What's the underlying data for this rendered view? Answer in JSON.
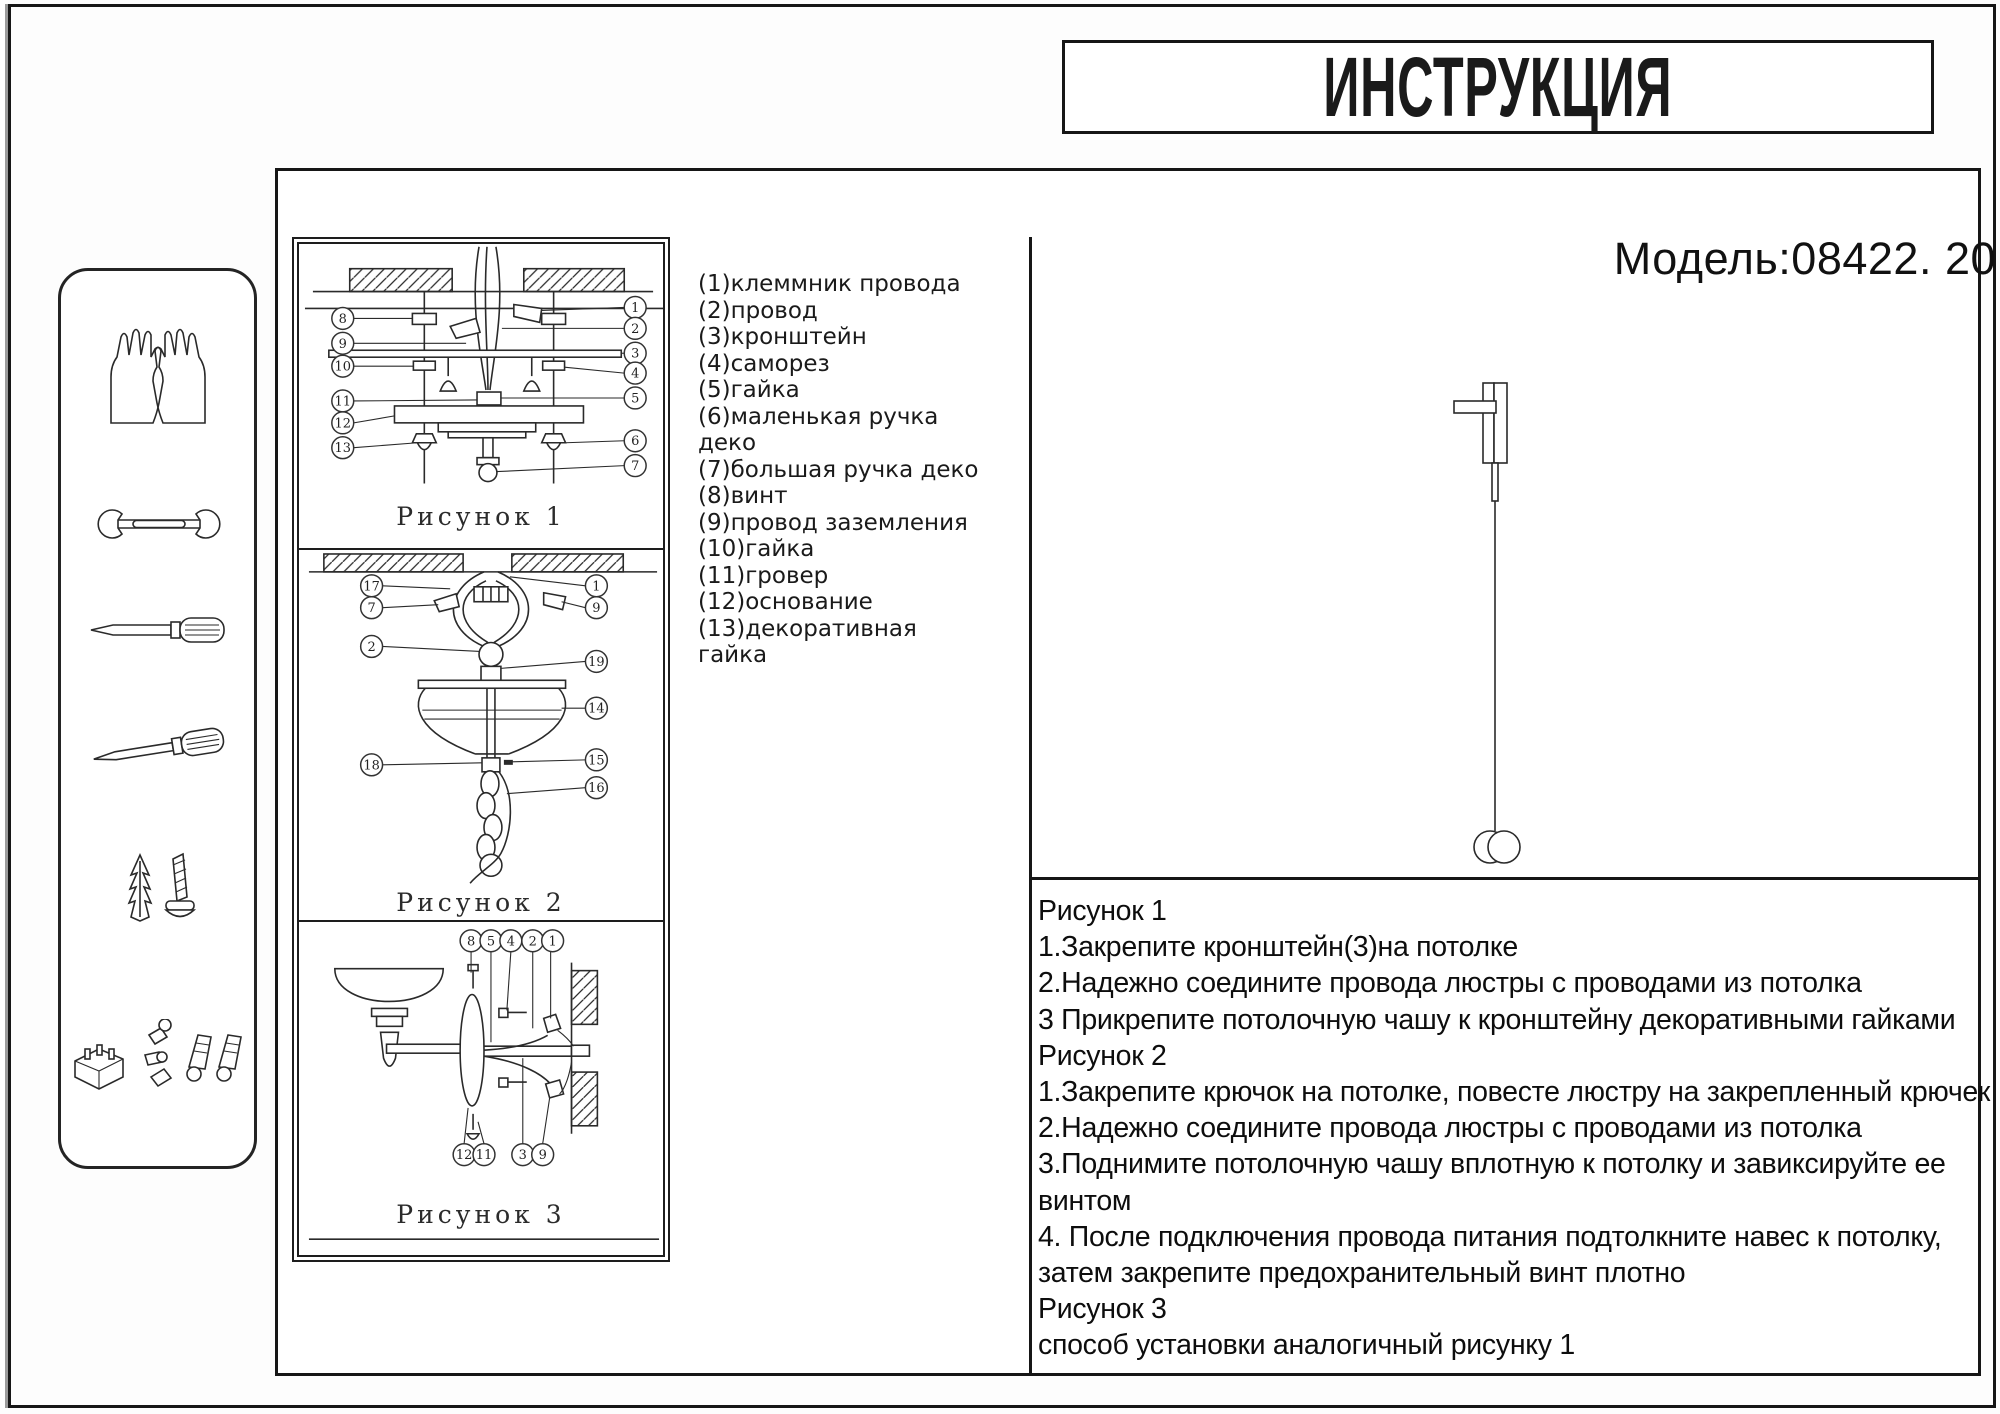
{
  "title": "ИНСТРУКЦИЯ",
  "model": "Модель:08422. 20",
  "colors": {
    "line": "#2a2a2a",
    "border": "#161616",
    "background": "#ffffff"
  },
  "parts_list": {
    "lines": [
      "(1)клеммник провода",
      "(2)провод",
      "(3)кронштейн",
      "(4)саморез",
      "(5)гайка",
      "(6)маленькая ручка",
      "деко",
      "(7)большая ручка деко",
      "(8)винт",
      "(9)провод заземления",
      "(10)гайка",
      "(11)гровер",
      "(12)основание",
      "(13)декоративная",
      "гайка"
    ]
  },
  "figures": {
    "fig1": {
      "caption": "Рисунок 1",
      "callouts_left": [
        "8",
        "9",
        "10",
        "11",
        "12",
        "13"
      ],
      "callouts_right": [
        "1",
        "2",
        "3",
        "4",
        "5",
        "6",
        "7"
      ]
    },
    "fig2": {
      "caption": "Рисунок 2",
      "callouts_left": [
        "17",
        "7",
        "2",
        "18"
      ],
      "callouts_right": [
        "1",
        "9",
        "19",
        "14",
        "15",
        "16"
      ]
    },
    "fig3": {
      "caption": "Рисунок 3",
      "callouts_top": [
        "8",
        "5",
        "4",
        "2",
        "1"
      ],
      "callouts_bottom": [
        "12",
        "11",
        "3",
        "9"
      ]
    }
  },
  "instructions": {
    "lines": [
      "Рисунок 1",
      "1.Закрепите кронштейн(3)на потолке",
      "2.Надежно соедините провода люстры с проводами из потолка",
      "3 Прикрепите потолочную чашу к кронштейну декоративными гайками",
      "Рисунок 2",
      "1.Закрепите крючок на потолке, повесте люстру на закрепленный крючек",
      "2.Надежно соедините провода люстры с проводами из потолка",
      "3.Поднимите потолочную чашу вплотную к потолку и завиксируйте ее",
      "винтом",
      "4.  После подключения провода питания подтолкните навес к потолку,",
      "затем закрепите предохранительный винт плотно",
      "Рисунок 3",
      "способ установки аналогичный рисунку 1"
    ]
  },
  "sidebar_icons": [
    "gloves",
    "wrench",
    "flat-screwdriver",
    "phillips-screwdriver",
    "wall-anchor-and-screw",
    "mounting-hardware"
  ]
}
